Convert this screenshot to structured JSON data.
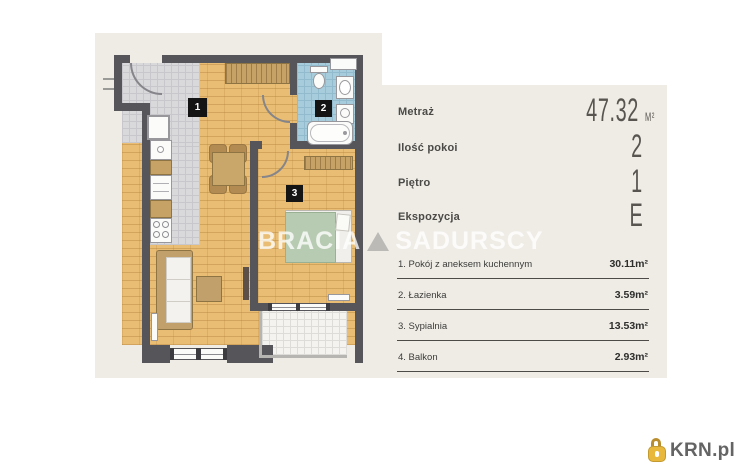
{
  "watermark": {
    "brand_left": "BRACIA",
    "brand_right": "SADURSCY"
  },
  "info_panel": {
    "rows": [
      {
        "label": "Metraż",
        "value": "47.32",
        "unit": "M²"
      },
      {
        "label": "Ilość pokoi",
        "value": "2"
      },
      {
        "label": "Piętro",
        "value": "1"
      },
      {
        "label": "Ekspozycja",
        "value": "E"
      }
    ],
    "rooms": [
      {
        "name": "1. Pokój z aneksem kuchennym",
        "area": "30.11m²"
      },
      {
        "name": "2. Łazienka",
        "area": "3.59m²"
      },
      {
        "name": "3. Sypialnia",
        "area": "13.53m²"
      },
      {
        "name": "4. Balkon",
        "area": "2.93m²"
      }
    ]
  },
  "floor_plan": {
    "room_labels": [
      "1",
      "2",
      "3"
    ]
  },
  "logo": {
    "text": "KRN.pl"
  },
  "colors": {
    "panel_beige": "#efece6",
    "wall": "#55555a",
    "wood_floor": "#e9bd73",
    "gray_tile": "#d9d9dc",
    "bathroom_tile": "#a7ccdc",
    "bed_green": "#b7cbb2",
    "logo_gold": "#e8b83d"
  }
}
